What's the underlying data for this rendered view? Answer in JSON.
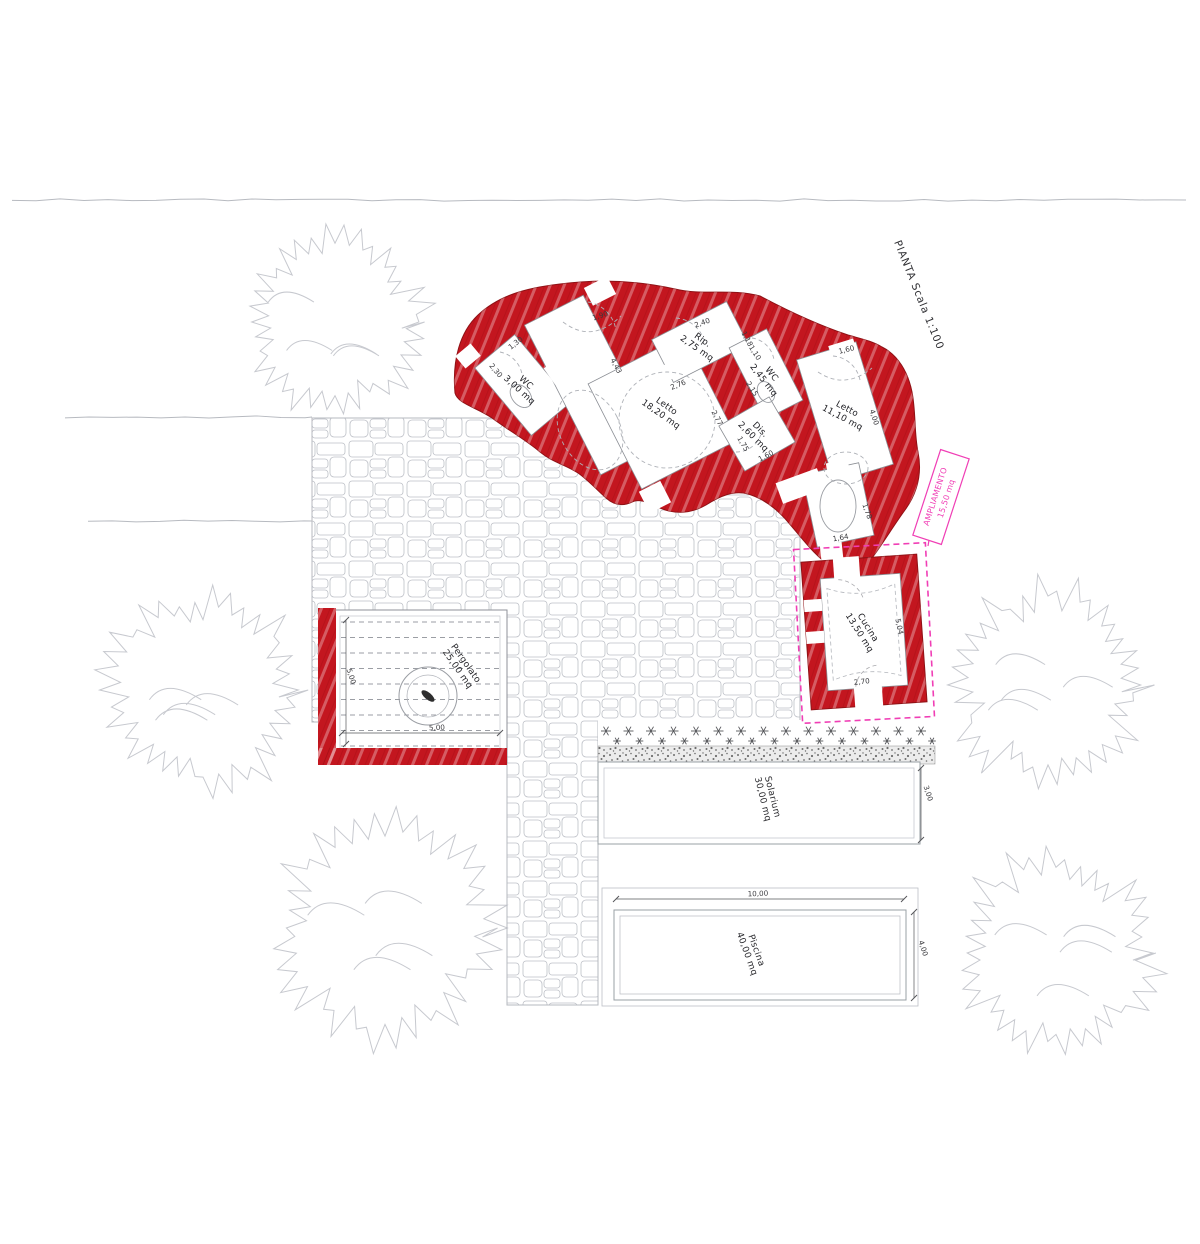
{
  "title": {
    "label": "PIANTA Scala 1:100"
  },
  "colors": {
    "wall_red": "#c3161f",
    "accent_pink": "#f03eb5",
    "drawing_gray": "#9aa0a6",
    "tree_gray": "#c7c9cf",
    "text_dark": "#2f2f33"
  },
  "annotation": {
    "label": "AMPLIAMENTO",
    "area": "15,50 mq"
  },
  "rooms": {
    "wc1": {
      "name": "WC",
      "area": "3,00 mq"
    },
    "letto1": {
      "name": "Letto",
      "area": "18,20 mq"
    },
    "rip": {
      "name": "Rip.",
      "area": "2,75 mq"
    },
    "wc2": {
      "name": "WC",
      "area": "2,45 mq"
    },
    "dis": {
      "name": "Dis.",
      "area": "2,60 mq"
    },
    "letto2": {
      "name": "Letto",
      "area": "11,10 mq"
    },
    "cucina": {
      "name": "Cucina",
      "area": "13,50 mq"
    },
    "pergolato": {
      "name": "Pergolato",
      "area": "25,00 mq"
    },
    "solarium": {
      "name": "Solarium",
      "area": "30,00 mq"
    },
    "piscina": {
      "name": "Piscina",
      "area": "40,00 mq"
    }
  },
  "dimensions": {
    "entry_top": "1,90",
    "entry_side": "4,43",
    "rip_top": "2,40",
    "rip_side": "1,18",
    "wc1_top": "1,30",
    "wc1_side": "2,30",
    "letto1_top": "2,76",
    "letto1_side": "2,77",
    "wc2_top": "1,10",
    "wc2_side": "2,15",
    "dis_side": "1,75",
    "dis_bottom": "1,60",
    "letto2_top": "1,60",
    "letto2_side": "4,00",
    "bagno_side": "1,78",
    "bagno_bottom": "1,64",
    "cucina_bottom": "2,70",
    "cucina_side": "5,04",
    "pergolato_bottom": "5,00",
    "pergolato_side": "5,00",
    "solarium_side": "3,00",
    "piscina_top": "10,00",
    "piscina_side": "4,00"
  }
}
